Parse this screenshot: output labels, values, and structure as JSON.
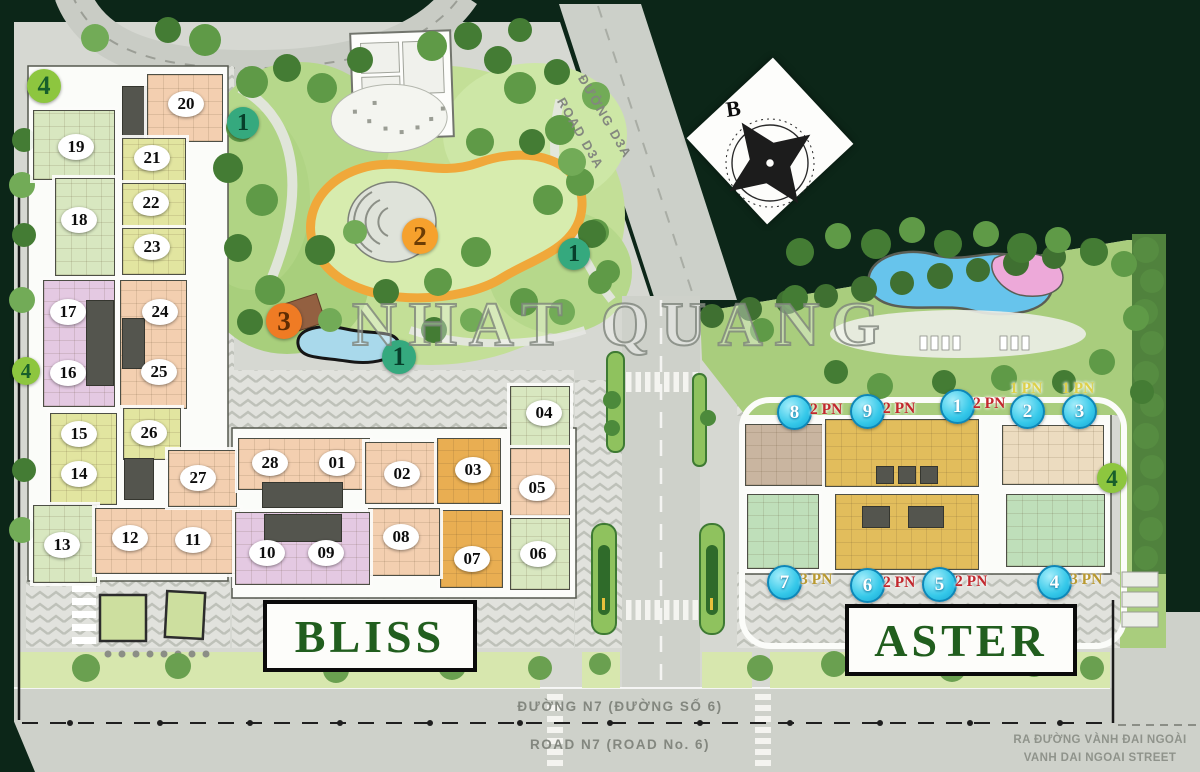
{
  "meta": {
    "project_watermark": "NHAT QUANG",
    "compass_north_label": "B"
  },
  "roads": {
    "d3a": {
      "vi": "ĐƯỜNG D3A",
      "en": "ROAD D3A"
    },
    "n7": {
      "vi": "ĐƯỜNG N7 (ĐƯỜNG SỐ 6)",
      "en": "ROAD N7 (ROAD No. 6)"
    },
    "exit": {
      "vi": "RA ĐƯỜNG VÀNH ĐAI NGOÀI",
      "en": "VANH DAI NGOAI STREET"
    }
  },
  "legend_colors": {
    "marker_cyan": "#35c8e9",
    "marker_green": "#35a97e",
    "marker_lime": "#8dc63f",
    "marker_orange_2": "#f6a12d",
    "marker_orange_3": "#ef7b24",
    "pn_red": "#c2272d",
    "pn_yellow": "#ddd04a",
    "pn_olive": "#b9992f",
    "building_name_green": "#215e1e"
  },
  "buildings": {
    "bliss": {
      "name": "BLISS",
      "units": [
        {
          "label": "20",
          "x": 186,
          "y": 104
        },
        {
          "label": "19",
          "x": 76,
          "y": 147
        },
        {
          "label": "21",
          "x": 152,
          "y": 158
        },
        {
          "label": "22",
          "x": 151,
          "y": 203
        },
        {
          "label": "18",
          "x": 79,
          "y": 220
        },
        {
          "label": "23",
          "x": 152,
          "y": 247
        },
        {
          "label": "17",
          "x": 68,
          "y": 312
        },
        {
          "label": "24",
          "x": 160,
          "y": 312
        },
        {
          "label": "16",
          "x": 68,
          "y": 373
        },
        {
          "label": "25",
          "x": 159,
          "y": 372
        },
        {
          "label": "15",
          "x": 79,
          "y": 434
        },
        {
          "label": "26",
          "x": 149,
          "y": 433
        },
        {
          "label": "14",
          "x": 79,
          "y": 474
        },
        {
          "label": "27",
          "x": 198,
          "y": 478
        },
        {
          "label": "13",
          "x": 62,
          "y": 545
        },
        {
          "label": "12",
          "x": 130,
          "y": 538
        },
        {
          "label": "11",
          "x": 193,
          "y": 540
        },
        {
          "label": "28",
          "x": 270,
          "y": 463
        },
        {
          "label": "01",
          "x": 337,
          "y": 463
        },
        {
          "label": "02",
          "x": 402,
          "y": 474
        },
        {
          "label": "03",
          "x": 473,
          "y": 470
        },
        {
          "label": "04",
          "x": 544,
          "y": 413
        },
        {
          "label": "05",
          "x": 537,
          "y": 488
        },
        {
          "label": "06",
          "x": 538,
          "y": 554
        },
        {
          "label": "07",
          "x": 472,
          "y": 559
        },
        {
          "label": "08",
          "x": 401,
          "y": 537
        },
        {
          "label": "09",
          "x": 326,
          "y": 553
        },
        {
          "label": "10",
          "x": 267,
          "y": 553
        }
      ]
    },
    "aster": {
      "name": "ASTER",
      "units": [
        {
          "num": "8",
          "pn": "2 PN",
          "x": 793,
          "y": 411,
          "pn_color": "#c2272d",
          "pn_side": "right"
        },
        {
          "num": "9",
          "pn": "2 PN",
          "x": 866,
          "y": 410,
          "pn_color": "#c2272d",
          "pn_side": "right"
        },
        {
          "num": "1",
          "pn": "2 PN",
          "x": 956,
          "y": 405,
          "pn_color": "#c2272d",
          "pn_side": "right"
        },
        {
          "num": "2",
          "pn": "1 PN",
          "x": 1026,
          "y": 410,
          "pn_color": "#ddd04a",
          "pn_side": "above"
        },
        {
          "num": "3",
          "pn": "1 PN",
          "x": 1078,
          "y": 410,
          "pn_color": "#ddd04a",
          "pn_side": "above"
        },
        {
          "num": "7",
          "pn": "3 PN",
          "x": 783,
          "y": 581,
          "pn_color": "#b9992f",
          "pn_side": "right"
        },
        {
          "num": "6",
          "pn": "2 PN",
          "x": 866,
          "y": 584,
          "pn_color": "#c2272d",
          "pn_side": "right"
        },
        {
          "num": "5",
          "pn": "2 PN",
          "x": 938,
          "y": 583,
          "pn_color": "#c2272d",
          "pn_side": "right"
        },
        {
          "num": "4",
          "pn": "3 PN",
          "x": 1053,
          "y": 581,
          "pn_color": "#b9992f",
          "pn_side": "right"
        }
      ]
    }
  },
  "amenity_markers": [
    {
      "num": "4",
      "x": 44,
      "y": 86,
      "r": 17,
      "fill": "#8dc63f",
      "text": "#175f2b"
    },
    {
      "num": "1",
      "x": 243,
      "y": 123,
      "r": 16,
      "fill": "#35a97e",
      "text": "#073f2b"
    },
    {
      "num": "2",
      "x": 420,
      "y": 236,
      "r": 18,
      "fill": "#f6a12d",
      "text": "#6b3c05"
    },
    {
      "num": "1",
      "x": 574,
      "y": 254,
      "r": 16,
      "fill": "#35a97e",
      "text": "#073f2b"
    },
    {
      "num": "3",
      "x": 284,
      "y": 321,
      "r": 18,
      "fill": "#ef7b24",
      "text": "#5f2c03"
    },
    {
      "num": "1",
      "x": 399,
      "y": 357,
      "r": 17,
      "fill": "#35a97e",
      "text": "#073f2b"
    },
    {
      "num": "4",
      "x": 26,
      "y": 371,
      "r": 14,
      "fill": "#8dc63f",
      "text": "#175f2b"
    },
    {
      "num": "4",
      "x": 1112,
      "y": 478,
      "r": 15,
      "fill": "#8dc63f",
      "text": "#175f2b"
    }
  ],
  "floorplate_blocks": [
    {
      "x": 122,
      "y": 86,
      "w": 27,
      "h": 56,
      "c": "gray"
    },
    {
      "x": 147,
      "y": 74,
      "w": 74,
      "h": 66,
      "c": "salmon"
    },
    {
      "x": 33,
      "y": 110,
      "w": 80,
      "h": 68,
      "c": "green"
    },
    {
      "x": 122,
      "y": 138,
      "w": 62,
      "h": 45,
      "c": "yellow"
    },
    {
      "x": 122,
      "y": 183,
      "w": 62,
      "h": 45,
      "c": "yellow"
    },
    {
      "x": 122,
      "y": 228,
      "w": 62,
      "h": 45,
      "c": "yellow"
    },
    {
      "x": 55,
      "y": 178,
      "w": 58,
      "h": 96,
      "c": "green"
    },
    {
      "x": 43,
      "y": 280,
      "w": 70,
      "h": 125,
      "c": "purple"
    },
    {
      "x": 86,
      "y": 300,
      "w": 26,
      "h": 84,
      "c": "gray"
    },
    {
      "x": 120,
      "y": 280,
      "w": 65,
      "h": 127,
      "c": "salmon"
    },
    {
      "x": 122,
      "y": 318,
      "w": 21,
      "h": 49,
      "c": "gray"
    },
    {
      "x": 50,
      "y": 413,
      "w": 65,
      "h": 90,
      "c": "yellow"
    },
    {
      "x": 123,
      "y": 408,
      "w": 56,
      "h": 50,
      "c": "yellow"
    },
    {
      "x": 124,
      "y": 458,
      "w": 28,
      "h": 40,
      "c": "gray"
    },
    {
      "x": 33,
      "y": 505,
      "w": 62,
      "h": 76,
      "c": "green"
    },
    {
      "x": 95,
      "y": 508,
      "w": 143,
      "h": 64,
      "c": "salmon"
    },
    {
      "x": 168,
      "y": 450,
      "w": 67,
      "h": 55,
      "c": "salmon"
    },
    {
      "x": 238,
      "y": 438,
      "w": 130,
      "h": 50,
      "c": "salmon"
    },
    {
      "x": 365,
      "y": 442,
      "w": 73,
      "h": 60,
      "c": "salmon"
    },
    {
      "x": 437,
      "y": 438,
      "w": 62,
      "h": 64,
      "c": "orange"
    },
    {
      "x": 510,
      "y": 386,
      "w": 58,
      "h": 62,
      "c": "green"
    },
    {
      "x": 510,
      "y": 448,
      "w": 58,
      "h": 66,
      "c": "salmon"
    },
    {
      "x": 510,
      "y": 518,
      "w": 58,
      "h": 70,
      "c": "green"
    },
    {
      "x": 440,
      "y": 510,
      "w": 61,
      "h": 76,
      "c": "orange"
    },
    {
      "x": 368,
      "y": 508,
      "w": 70,
      "h": 66,
      "c": "salmon"
    },
    {
      "x": 235,
      "y": 512,
      "w": 133,
      "h": 71,
      "c": "purple"
    },
    {
      "x": 262,
      "y": 482,
      "w": 79,
      "h": 24,
      "c": "gray"
    },
    {
      "x": 264,
      "y": 514,
      "w": 76,
      "h": 26,
      "c": "gray"
    },
    {
      "x": 745,
      "y": 424,
      "w": 78,
      "h": 60,
      "c": "tan"
    },
    {
      "x": 825,
      "y": 419,
      "w": 152,
      "h": 66,
      "c": "mustard"
    },
    {
      "x": 1002,
      "y": 425,
      "w": 100,
      "h": 58,
      "c": "cream"
    },
    {
      "x": 747,
      "y": 494,
      "w": 70,
      "h": 73,
      "c": "astergreen"
    },
    {
      "x": 835,
      "y": 494,
      "w": 142,
      "h": 74,
      "c": "mustard"
    },
    {
      "x": 1006,
      "y": 494,
      "w": 97,
      "h": 71,
      "c": "astergreen"
    },
    {
      "x": 876,
      "y": 466,
      "w": 16,
      "h": 16,
      "c": "gray"
    },
    {
      "x": 898,
      "y": 466,
      "w": 16,
      "h": 16,
      "c": "gray"
    },
    {
      "x": 920,
      "y": 466,
      "w": 16,
      "h": 16,
      "c": "gray"
    },
    {
      "x": 862,
      "y": 506,
      "w": 26,
      "h": 20,
      "c": "gray"
    },
    {
      "x": 908,
      "y": 506,
      "w": 34,
      "h": 20,
      "c": "gray"
    }
  ]
}
